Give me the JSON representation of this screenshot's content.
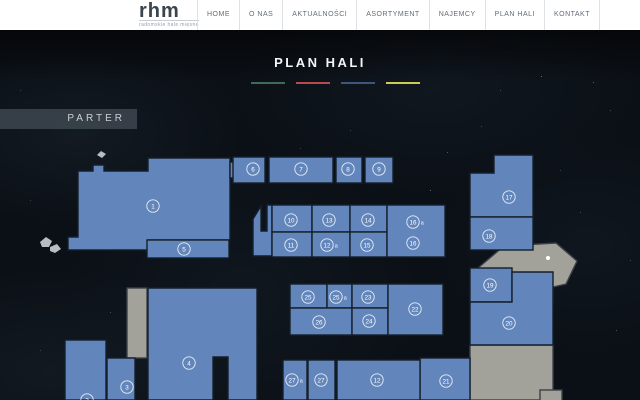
{
  "header": {
    "logo": {
      "text": "rhm",
      "tagline": "radomskie hale mięsne"
    },
    "nav": [
      {
        "label": "HOME"
      },
      {
        "label": "O NAS"
      },
      {
        "label": "AKTUALNOŚCI"
      },
      {
        "label": "ASORTYMENT"
      },
      {
        "label": "NAJEMCY"
      },
      {
        "label": "PLAN HALI"
      },
      {
        "label": "KONTAKT"
      }
    ]
  },
  "main": {
    "title": "PLAN HALI",
    "floor_label": "PARTER",
    "legend_colors": [
      "#3e6a57",
      "#b8494d",
      "#41547b",
      "#cbcd51"
    ]
  },
  "plan": {
    "colors": {
      "blue_fill": "#6286bb",
      "blue_stroke": "#141f2c",
      "gray_fill": "#a3a29a",
      "gray_stroke": "#3c4148",
      "rock_fill": "#b7bdc2",
      "white_fill": "#ffffff",
      "badge_color": "#ffffff"
    },
    "shapes": [
      {
        "name": "gray-strip",
        "type": "rect",
        "fill": "gray",
        "interactable": false,
        "x": 127,
        "y": 288,
        "w": 20,
        "h": 70,
        "badges": []
      },
      {
        "name": "gray-area-top",
        "type": "poly",
        "fill": "gray",
        "interactable": false,
        "points": [
          [
            478,
            268
          ],
          [
            504,
            246
          ],
          [
            556,
            243
          ],
          [
            577,
            261
          ],
          [
            566,
            284
          ],
          [
            553,
            287
          ],
          [
            553,
            303
          ],
          [
            486,
            303
          ],
          [
            478,
            292
          ]
        ],
        "badges": []
      },
      {
        "name": "gray-area-bottom",
        "type": "rect",
        "fill": "gray",
        "interactable": false,
        "x": 470,
        "y": 345,
        "w": 83,
        "h": 55,
        "badges": []
      },
      {
        "name": "gray-box-small",
        "type": "rect",
        "fill": "gray",
        "interactable": false,
        "x": 540,
        "y": 390,
        "w": 22,
        "h": 12,
        "badges": []
      },
      {
        "name": "unit-1",
        "type": "poly",
        "fill": "blue",
        "interactable": true,
        "points": [
          [
            78,
            171
          ],
          [
            93,
            171
          ],
          [
            93,
            165
          ],
          [
            104,
            165
          ],
          [
            104,
            171
          ],
          [
            148,
            171
          ],
          [
            148,
            158
          ],
          [
            230,
            158
          ],
          [
            230,
            240
          ],
          [
            148,
            240
          ],
          [
            148,
            250
          ],
          [
            68,
            250
          ],
          [
            68,
            237
          ],
          [
            78,
            237
          ]
        ],
        "badges": [
          {
            "x": 153,
            "y": 206,
            "num": "1"
          }
        ]
      },
      {
        "name": "unit-5",
        "type": "rect",
        "fill": "blue",
        "interactable": true,
        "x": 147,
        "y": 240,
        "w": 82,
        "h": 18,
        "badges": [
          {
            "x": 184,
            "y": 249,
            "num": "5"
          }
        ]
      },
      {
        "name": "fragment-left-of-6",
        "type": "rect",
        "fill": "blue",
        "interactable": false,
        "x": 230,
        "y": 162,
        "w": 11,
        "h": 16,
        "badges": []
      },
      {
        "name": "unit-6",
        "type": "rect",
        "fill": "blue",
        "interactable": true,
        "x": 233,
        "y": 157,
        "w": 32,
        "h": 26,
        "badges": [
          {
            "x": 253,
            "y": 169,
            "num": "6"
          }
        ]
      },
      {
        "name": "unit-7",
        "type": "rect",
        "fill": "blue",
        "interactable": true,
        "x": 269,
        "y": 157,
        "w": 64,
        "h": 26,
        "badges": [
          {
            "x": 301,
            "y": 169,
            "num": "7"
          }
        ]
      },
      {
        "name": "unit-8",
        "type": "rect",
        "fill": "blue",
        "interactable": true,
        "x": 336,
        "y": 157,
        "w": 26,
        "h": 26,
        "badges": [
          {
            "x": 348,
            "y": 169,
            "num": "8"
          }
        ]
      },
      {
        "name": "unit-9",
        "type": "rect",
        "fill": "blue",
        "interactable": true,
        "x": 365,
        "y": 157,
        "w": 28,
        "h": 26,
        "badges": [
          {
            "x": 379,
            "y": 169,
            "num": "9"
          }
        ]
      },
      {
        "name": "unit-17",
        "type": "poly",
        "fill": "blue",
        "interactable": true,
        "points": [
          [
            470,
            173
          ],
          [
            494,
            173
          ],
          [
            494,
            155
          ],
          [
            533,
            155
          ],
          [
            533,
            217
          ],
          [
            470,
            217
          ]
        ],
        "badges": [
          {
            "x": 509,
            "y": 197,
            "num": "17"
          }
        ]
      },
      {
        "name": "unit-18",
        "type": "rect",
        "fill": "blue",
        "interactable": true,
        "x": 470,
        "y": 217,
        "w": 63,
        "h": 33,
        "badges": [
          {
            "x": 489,
            "y": 236,
            "num": "18"
          }
        ]
      },
      {
        "name": "corridor-piece",
        "type": "poly",
        "fill": "blue",
        "interactable": false,
        "points": [
          [
            253,
            219
          ],
          [
            261,
            206
          ],
          [
            261,
            231
          ],
          [
            267,
            231
          ],
          [
            267,
            205
          ],
          [
            272,
            205
          ],
          [
            272,
            256
          ],
          [
            253,
            256
          ]
        ],
        "badges": []
      },
      {
        "name": "unit-10",
        "type": "rect",
        "fill": "blue",
        "interactable": true,
        "x": 272,
        "y": 205,
        "w": 40,
        "h": 27,
        "badges": [
          {
            "x": 291,
            "y": 220,
            "num": "10"
          }
        ]
      },
      {
        "name": "unit-13",
        "type": "rect",
        "fill": "blue",
        "interactable": true,
        "x": 312,
        "y": 205,
        "w": 38,
        "h": 27,
        "badges": [
          {
            "x": 329,
            "y": 220,
            "num": "13"
          }
        ]
      },
      {
        "name": "unit-14",
        "type": "rect",
        "fill": "blue",
        "interactable": true,
        "x": 350,
        "y": 205,
        "w": 37,
        "h": 27,
        "badges": [
          {
            "x": 368,
            "y": 220,
            "num": "14"
          }
        ]
      },
      {
        "name": "unit-11",
        "type": "rect",
        "fill": "blue",
        "interactable": true,
        "x": 272,
        "y": 232,
        "w": 40,
        "h": 25,
        "badges": [
          {
            "x": 291,
            "y": 245,
            "num": "11"
          }
        ]
      },
      {
        "name": "unit-12a",
        "type": "rect",
        "fill": "blue",
        "interactable": true,
        "x": 312,
        "y": 232,
        "w": 38,
        "h": 25,
        "badges": [
          {
            "x": 327,
            "y": 245,
            "num": "12",
            "suffix": "a"
          }
        ]
      },
      {
        "name": "unit-15",
        "type": "rect",
        "fill": "blue",
        "interactable": true,
        "x": 350,
        "y": 232,
        "w": 37,
        "h": 25,
        "badges": [
          {
            "x": 367,
            "y": 245,
            "num": "15"
          }
        ]
      },
      {
        "name": "unit-16",
        "type": "rect",
        "fill": "blue",
        "interactable": true,
        "x": 387,
        "y": 205,
        "w": 58,
        "h": 52,
        "badges": [
          {
            "x": 413,
            "y": 222,
            "num": "16",
            "suffix": "a"
          },
          {
            "x": 413,
            "y": 243,
            "num": "16"
          }
        ]
      },
      {
        "name": "unit-25",
        "type": "rect",
        "fill": "blue",
        "interactable": true,
        "x": 290,
        "y": 284,
        "w": 37,
        "h": 24,
        "badges": [
          {
            "x": 308,
            "y": 297,
            "num": "25"
          }
        ]
      },
      {
        "name": "unit-25a",
        "type": "rect",
        "fill": "blue",
        "interactable": true,
        "x": 327,
        "y": 284,
        "w": 25,
        "h": 24,
        "badges": [
          {
            "x": 336,
            "y": 297,
            "num": "25",
            "suffix": "a"
          }
        ]
      },
      {
        "name": "unit-23",
        "type": "rect",
        "fill": "blue",
        "interactable": true,
        "x": 352,
        "y": 284,
        "w": 36,
        "h": 24,
        "badges": [
          {
            "x": 368,
            "y": 297,
            "num": "23"
          }
        ]
      },
      {
        "name": "unit-26",
        "type": "rect",
        "fill": "blue",
        "interactable": true,
        "x": 290,
        "y": 308,
        "w": 62,
        "h": 27,
        "badges": [
          {
            "x": 319,
            "y": 322,
            "num": "26"
          }
        ]
      },
      {
        "name": "unit-24",
        "type": "rect",
        "fill": "blue",
        "interactable": true,
        "x": 352,
        "y": 308,
        "w": 36,
        "h": 27,
        "badges": [
          {
            "x": 369,
            "y": 321,
            "num": "24"
          }
        ]
      },
      {
        "name": "unit-22",
        "type": "rect",
        "fill": "blue",
        "interactable": true,
        "x": 388,
        "y": 284,
        "w": 55,
        "h": 51,
        "badges": [
          {
            "x": 415,
            "y": 309,
            "num": "22"
          }
        ]
      },
      {
        "name": "unit-19",
        "type": "rect",
        "fill": "blue",
        "interactable": true,
        "x": 470,
        "y": 268,
        "w": 42,
        "h": 34,
        "badges": [
          {
            "x": 490,
            "y": 285,
            "num": "19"
          }
        ]
      },
      {
        "name": "unit-20",
        "type": "poly",
        "fill": "blue",
        "interactable": true,
        "points": [
          [
            512,
            272
          ],
          [
            553,
            272
          ],
          [
            553,
            345
          ],
          [
            470,
            345
          ],
          [
            470,
            302
          ],
          [
            512,
            302
          ]
        ],
        "badges": [
          {
            "x": 509,
            "y": 323,
            "num": "20"
          }
        ]
      },
      {
        "name": "unit-21",
        "type": "rect",
        "fill": "blue",
        "interactable": true,
        "x": 420,
        "y": 358,
        "w": 50,
        "h": 42,
        "badges": [
          {
            "x": 446,
            "y": 381,
            "num": "21"
          }
        ]
      },
      {
        "name": "unit-27a",
        "type": "rect",
        "fill": "blue",
        "interactable": true,
        "x": 283,
        "y": 360,
        "w": 24,
        "h": 40,
        "badges": [
          {
            "x": 292,
            "y": 380,
            "num": "27",
            "suffix": "a"
          }
        ]
      },
      {
        "name": "unit-27",
        "type": "rect",
        "fill": "blue",
        "interactable": true,
        "x": 308,
        "y": 360,
        "w": 27,
        "h": 40,
        "badges": [
          {
            "x": 321,
            "y": 380,
            "num": "27"
          }
        ]
      },
      {
        "name": "unit-12",
        "type": "rect",
        "fill": "blue",
        "interactable": true,
        "x": 337,
        "y": 360,
        "w": 83,
        "h": 40,
        "badges": [
          {
            "x": 377,
            "y": 380,
            "num": "12"
          }
        ]
      },
      {
        "name": "unit-4",
        "type": "poly",
        "fill": "blue",
        "interactable": true,
        "points": [
          [
            148,
            288
          ],
          [
            257,
            288
          ],
          [
            257,
            400
          ],
          [
            228,
            400
          ],
          [
            228,
            357
          ],
          [
            213,
            357
          ],
          [
            213,
            400
          ],
          [
            148,
            400
          ]
        ],
        "badges": [
          {
            "x": 189,
            "y": 363,
            "num": "4"
          }
        ]
      },
      {
        "name": "unit-3",
        "type": "rect",
        "fill": "blue",
        "interactable": true,
        "x": 107,
        "y": 358,
        "w": 28,
        "h": 42,
        "badges": [
          {
            "x": 127,
            "y": 387,
            "num": "3"
          }
        ]
      },
      {
        "name": "unit-2",
        "type": "rect",
        "fill": "blue",
        "interactable": true,
        "x": 65,
        "y": 340,
        "w": 41,
        "h": 60,
        "badges": [
          {
            "x": 87,
            "y": 400,
            "num": "2"
          }
        ]
      },
      {
        "name": "rock-1",
        "type": "poly",
        "fill": "rock",
        "interactable": false,
        "points": [
          [
            40,
            242
          ],
          [
            46,
            237
          ],
          [
            52,
            241
          ],
          [
            49,
            247
          ],
          [
            42,
            247
          ]
        ],
        "badges": []
      },
      {
        "name": "rock-2",
        "type": "poly",
        "fill": "rock",
        "interactable": false,
        "points": [
          [
            50,
            247
          ],
          [
            57,
            244
          ],
          [
            61,
            249
          ],
          [
            55,
            253
          ],
          [
            50,
            251
          ]
        ],
        "badges": []
      },
      {
        "name": "rock-3",
        "type": "poly",
        "fill": "rock",
        "interactable": false,
        "points": [
          [
            97,
            155
          ],
          [
            101,
            151
          ],
          [
            106,
            154
          ],
          [
            102,
            158
          ]
        ],
        "badges": []
      },
      {
        "name": "marker-dot",
        "type": "circle",
        "fill": "white",
        "interactable": false,
        "x": 548,
        "y": 258,
        "r": 2,
        "badges": []
      }
    ]
  }
}
